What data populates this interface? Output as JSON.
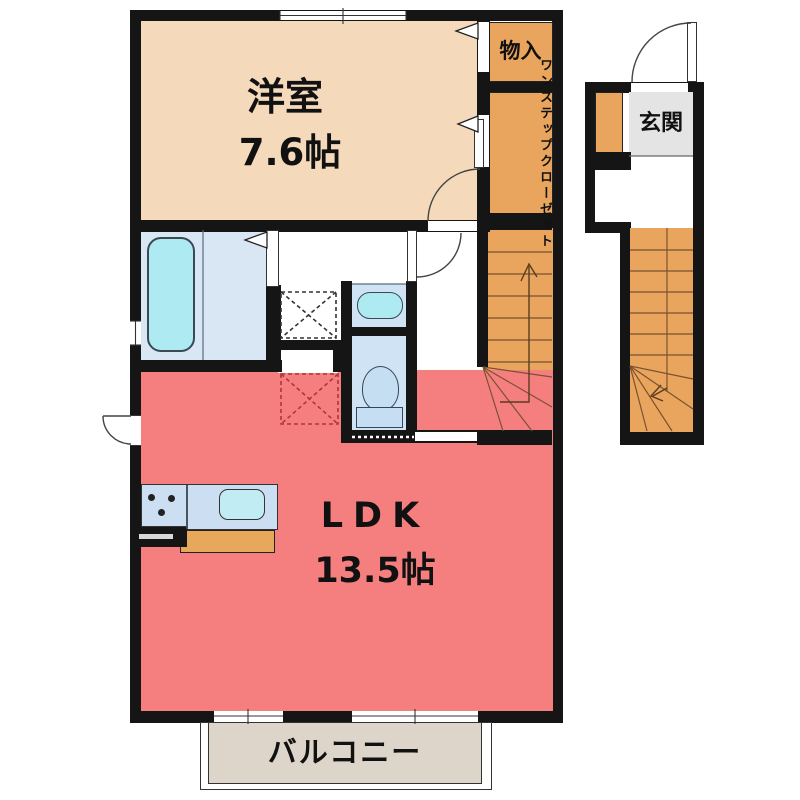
{
  "floorplan": {
    "rooms": {
      "western_room": {
        "label": "洋室",
        "area": "7.6帖"
      },
      "ldk": {
        "label": "LDK",
        "area": "13.5帖"
      },
      "storage": {
        "label": "物入"
      },
      "step_closet": {
        "label_full": "ワンステップクローゼット",
        "column_right": "ワンステップ",
        "column_left": "クローゼット"
      },
      "entrance": {
        "label": "玄関"
      },
      "balcony": {
        "label": "バルコニー"
      }
    },
    "features": [
      "bathtub",
      "washing-machine-space",
      "washbasin",
      "toilet",
      "kitchen-counter-with-sink-and-stove",
      "internal-staircase",
      "external-staircase",
      "refrigerator-space",
      "balcony-windows"
    ],
    "colors": {
      "wall": "#151515",
      "western_room_floor": "#f4d9bb",
      "storage_stairs_orange": "#e9a55d",
      "ldk_floor": "#f57f7f",
      "bathroom_floor": "#d9e7f4",
      "bathtub_fill": "#aeeaf2",
      "sanitary_floor": "#cfe3f4",
      "fixture_fill": "#c6def2",
      "kitchen_counter": "#ccdff2",
      "kitchen_sink": "#c2ecf4",
      "kitchen_cabinet": "#e8a85c",
      "balcony_floor": "#ddd5c9",
      "entrance_floor": "#e4e4e4"
    }
  }
}
